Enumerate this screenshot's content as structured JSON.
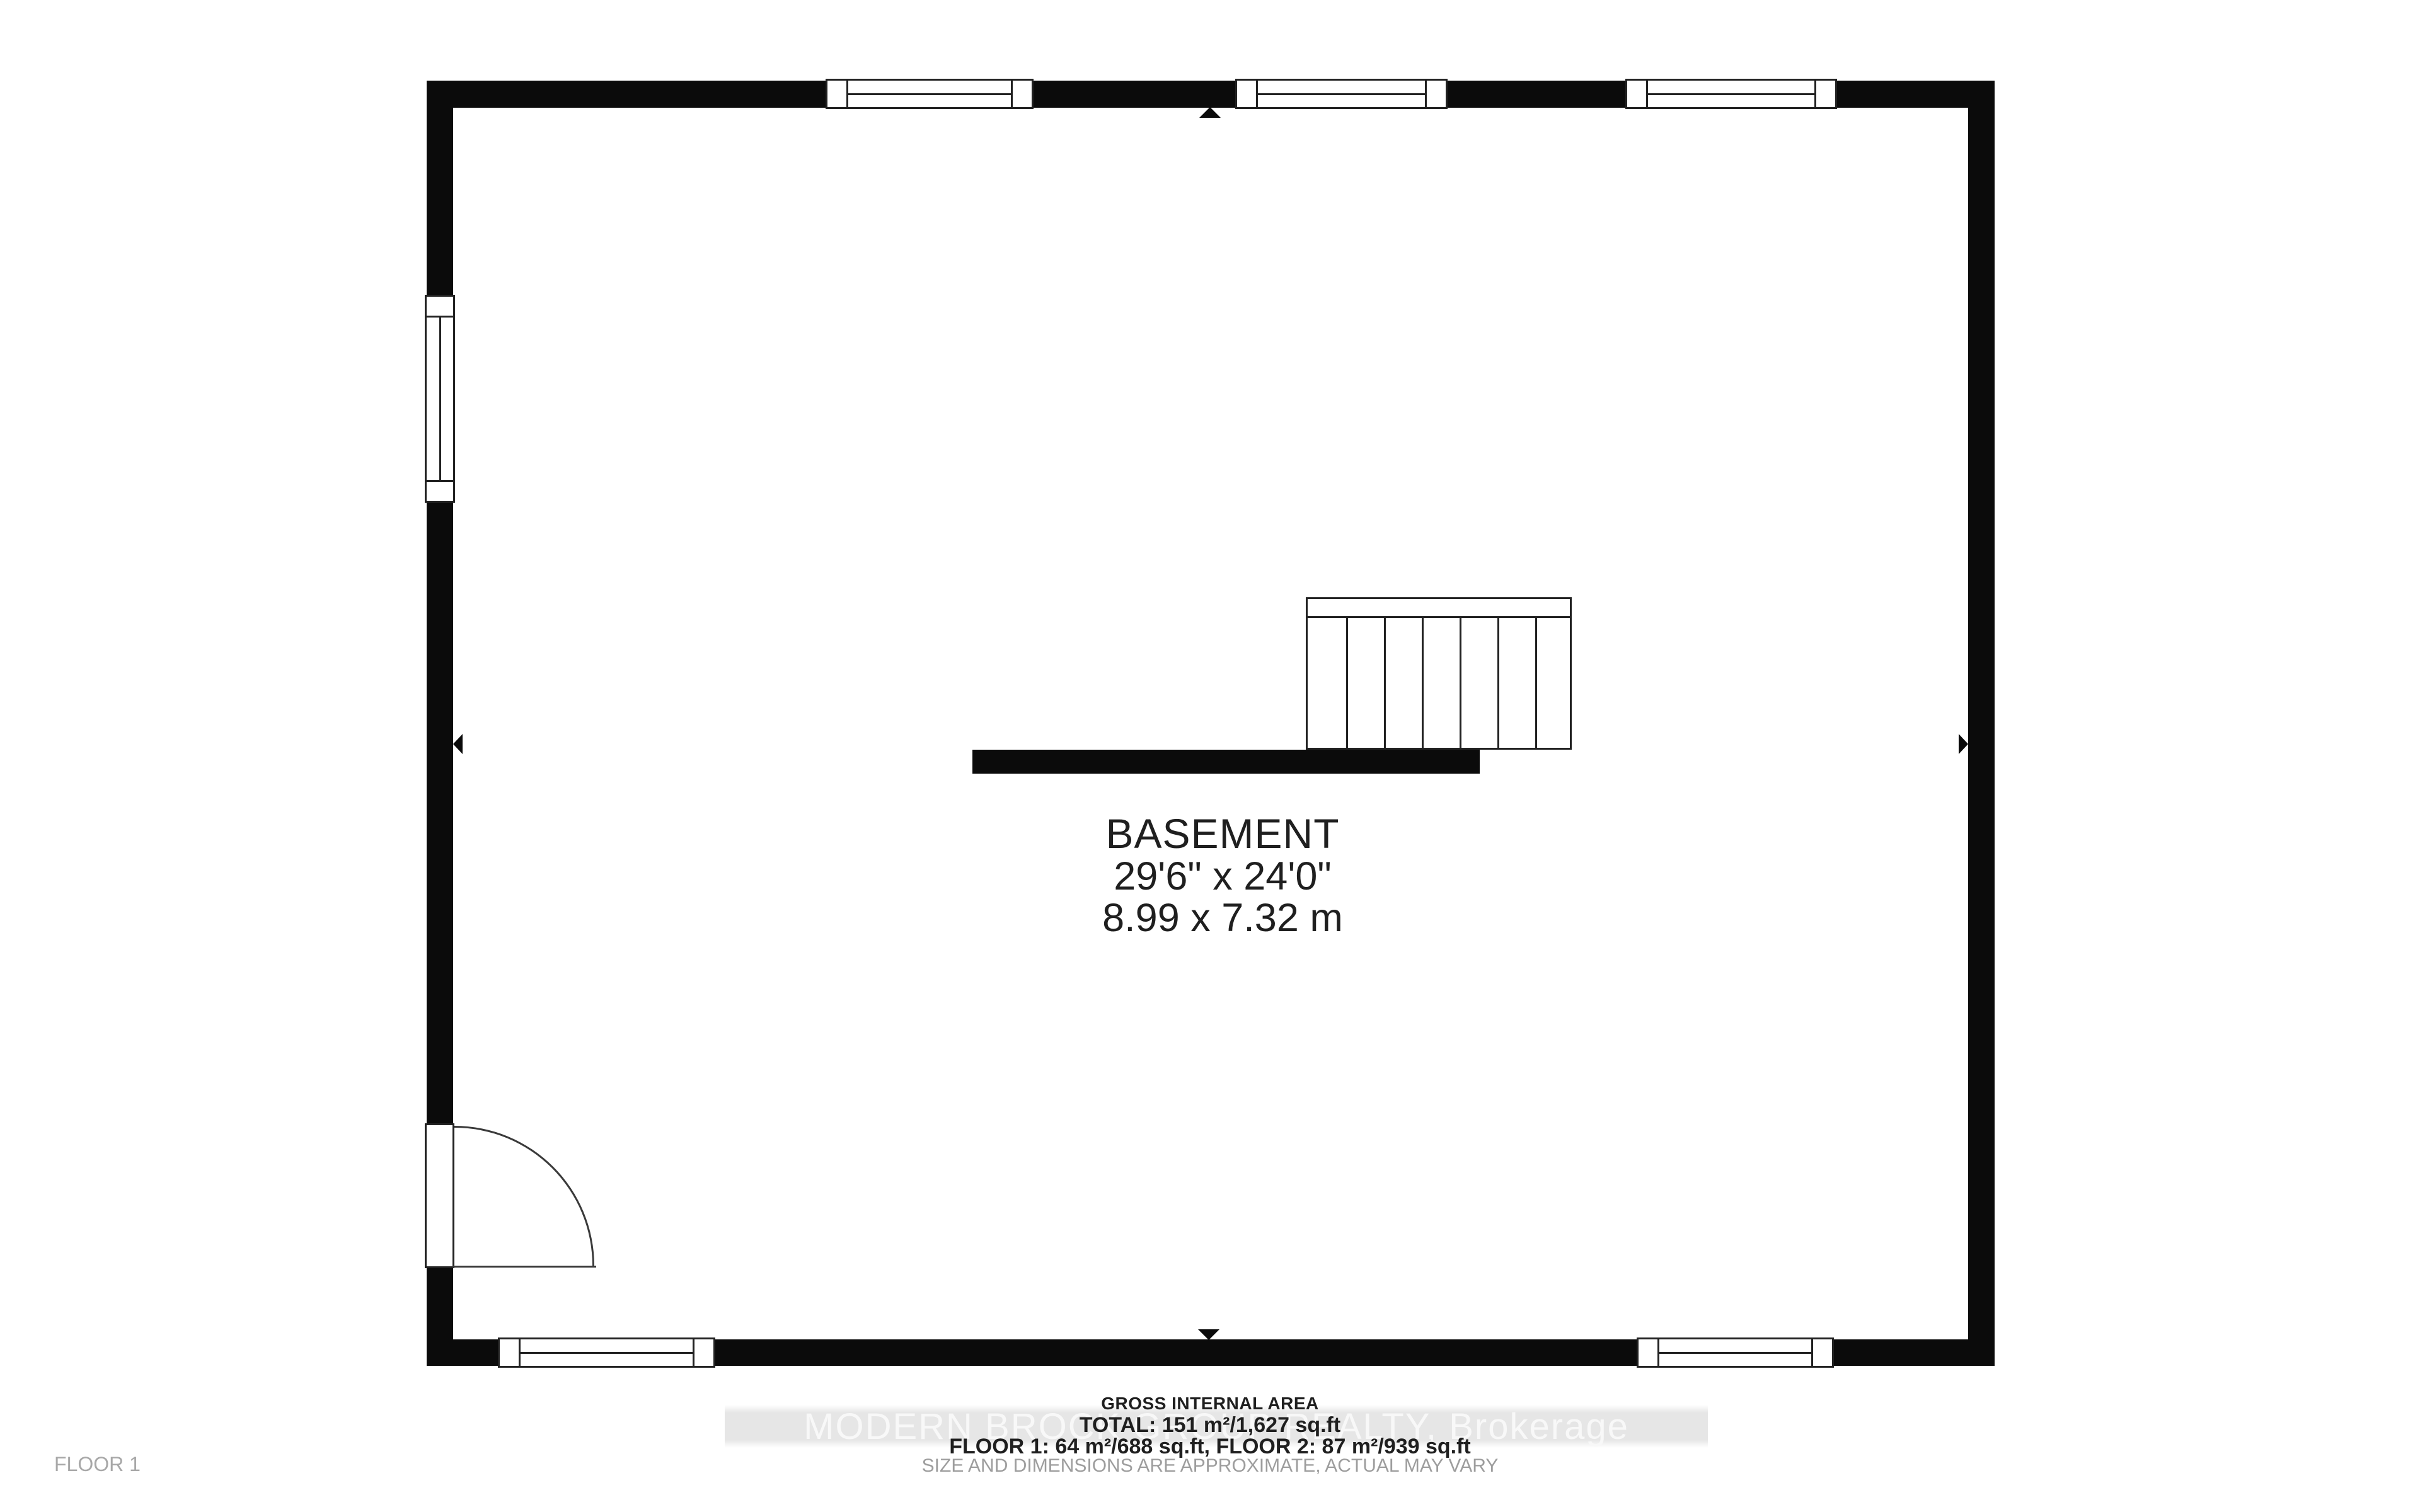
{
  "room_label": {
    "name": "BASEMENT",
    "dimensions_imperial": "29'6\" x 24'0\"",
    "dimensions_metric": "8.99 x 7.32 m"
  },
  "footer": {
    "gross_area_title": "GROSS INTERNAL AREA",
    "total_area": "TOTAL: 151 m²/1,627 sq.ft",
    "floor_areas": "FLOOR 1: 64 m²/688 sq.ft, FLOOR 2: 87 m²/939 sq.ft",
    "disclaimer": "SIZE AND DIMENSIONS ARE APPROXIMATE, ACTUAL MAY VARY",
    "floor_label": "FLOOR 1"
  },
  "watermark": {
    "text": "MODERN BROCK GROUP REALTY, Brokerage"
  },
  "colors": {
    "wall": "#0b0b0b",
    "line": "#222222",
    "text": "#1f1f1f",
    "muted": "#9d9d9d",
    "wm-band": "#e6e6e6",
    "wm-text": "#f8f8f8",
    "bg": "#ffffff"
  }
}
